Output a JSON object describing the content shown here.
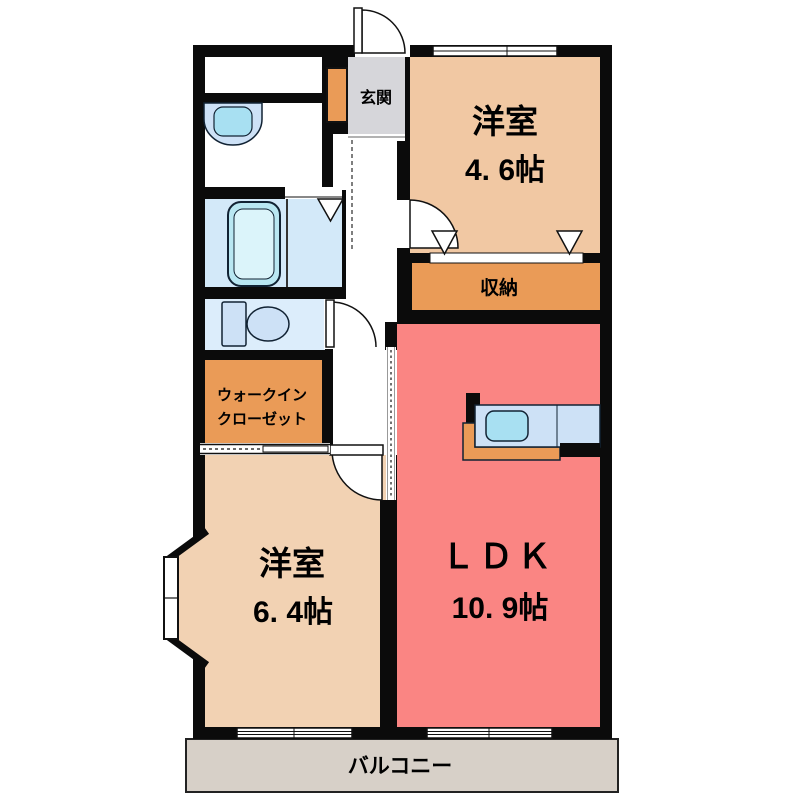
{
  "floor_plan": {
    "genkan": {
      "label": "玄関"
    },
    "western_room_1": {
      "label": "洋室",
      "size": "4. 6帖"
    },
    "storage": {
      "label": "収納"
    },
    "ldk": {
      "label": "ＬＤＫ",
      "size": "10. 9帖"
    },
    "walk_in_closet": {
      "line1": "ウォークイン",
      "line2": "クローゼット"
    },
    "western_room_2": {
      "label": "洋室",
      "size": "6. 4帖"
    },
    "balcony": {
      "label": "バルコニー"
    }
  },
  "colors": {
    "wall": "#0b0b0b",
    "room_46": "#f1c8a3",
    "room_64": "#f2d2b3",
    "ldk_red": "#fa8583",
    "closet_orange": "#ea9b57",
    "genkan_gray": "#d6d6da",
    "balcony_gray": "#d7d0c8",
    "bath_blue": "#d3e9f9",
    "toilet_blue": "#dcedfb",
    "fixture_blue": "#cde1f6",
    "sink_cyan": "#a8e0f2",
    "tub_fill": "#b9e7f2",
    "tub_inner": "#dbf4fa"
  }
}
